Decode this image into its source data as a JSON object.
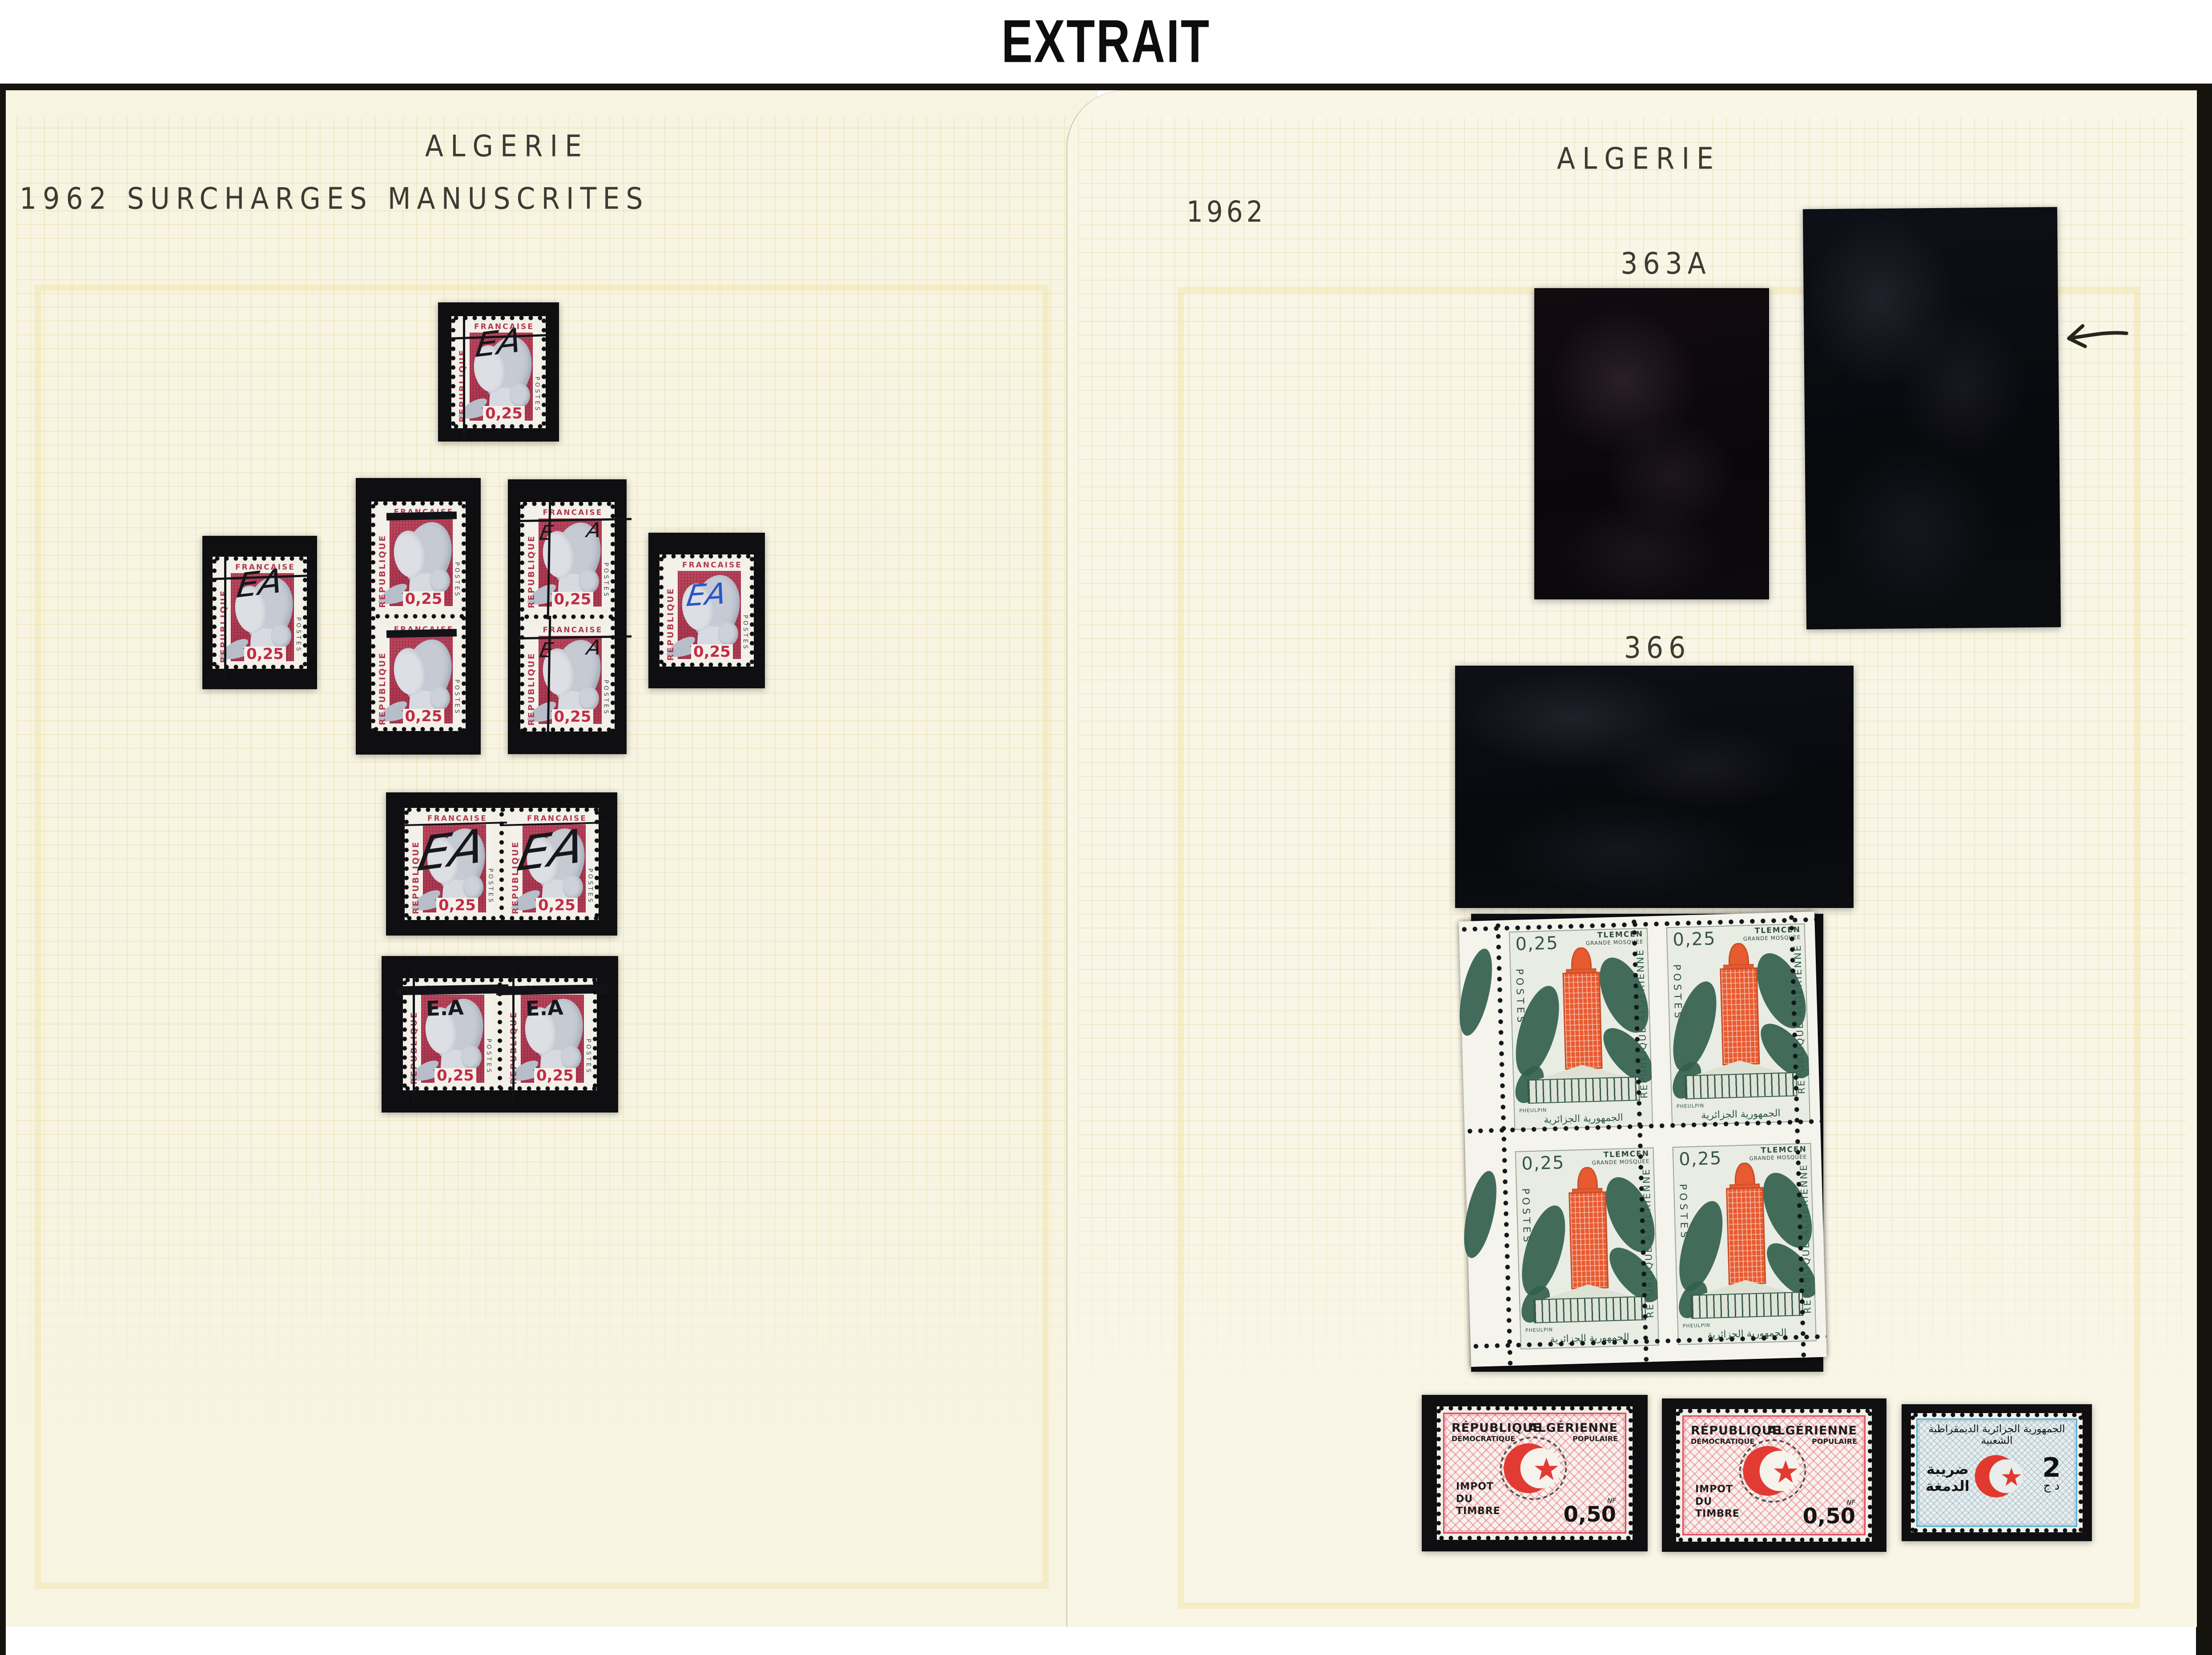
{
  "header": {
    "title": "EXTRAIT"
  },
  "left_page": {
    "title": "ALGERIE",
    "subtitle": "1962 SURCHARGES MANUSCRITES",
    "marianne": {
      "country_left": "REPUBLIQUE",
      "country_top": "FRANCAISE",
      "postes": "POSTES",
      "value": "0,25"
    },
    "stamps": [
      {
        "id": "single-top",
        "kind": "single",
        "overprint": "ea-script",
        "ov_text": "EA"
      },
      {
        "id": "vpair-left",
        "kind": "vpair",
        "overprint": "bar",
        "ov_text": ""
      },
      {
        "id": "vpair-right",
        "kind": "vpair",
        "overprint": "ea-lines",
        "ov_text": "EA"
      },
      {
        "id": "single-left",
        "kind": "single",
        "overprint": "ea-script",
        "ov_text": "EA"
      },
      {
        "id": "single-right",
        "kind": "single",
        "overprint": "ea-blue",
        "ov_text": "EA"
      },
      {
        "id": "hpair-middle",
        "kind": "hpair",
        "overprint": "ea-big",
        "ov_text": "EA"
      },
      {
        "id": "hpair-bottom",
        "kind": "hpair",
        "overprint": "ea-dot-bar",
        "ov_text": "E.A"
      }
    ]
  },
  "right_page": {
    "title": "ALGERIE",
    "year": "1962",
    "label_363a": "363A",
    "label_366": "366",
    "arrow_icon": "left-arrow-icon",
    "mosque": {
      "value": "0,25",
      "postes": "POSTES",
      "city": "TLEMCEN",
      "monument": "GRANDE MOSQUEE",
      "country": "REPUBLIQUE ALGERIENNE",
      "engraver": "PHEULPIN",
      "arabic": "الجمهورية الجزائرية"
    },
    "revenue_red": {
      "line1": "RÉPUBLIQUE",
      "line2": "DÉMOCRATIQUE",
      "line3": "ALGÉRIENNE",
      "line4": "POPULAIRE",
      "tax1": "IMPOT",
      "tax2": "DU",
      "tax3": "TIMBRE",
      "currency": "NF",
      "value": "0,50",
      "crescent_icon": "crescent-star-icon"
    },
    "revenue_blue": {
      "arabic_title": "الجمهورية الجزائرية الديمقراطية الشعبية",
      "arabic_left1": "ضريبة",
      "arabic_left2": "الدمغة",
      "value": "2",
      "currency": "د ج",
      "crescent_icon": "crescent-star-icon"
    }
  },
  "colors": {
    "page_cream": "#f8f4e2",
    "grid_line": "#d5c275",
    "mount_black": "#0f0f12",
    "marianne_red": "#b8455c",
    "overprint_black": "#17181c",
    "overprint_blue": "#2b55c8",
    "mosque_orange": "#e85a30",
    "mosque_green": "#2f5a46",
    "revenue_red": "#e04a5e",
    "revenue_blue": "#58b5d6",
    "crescent_red": "#e23b33"
  }
}
